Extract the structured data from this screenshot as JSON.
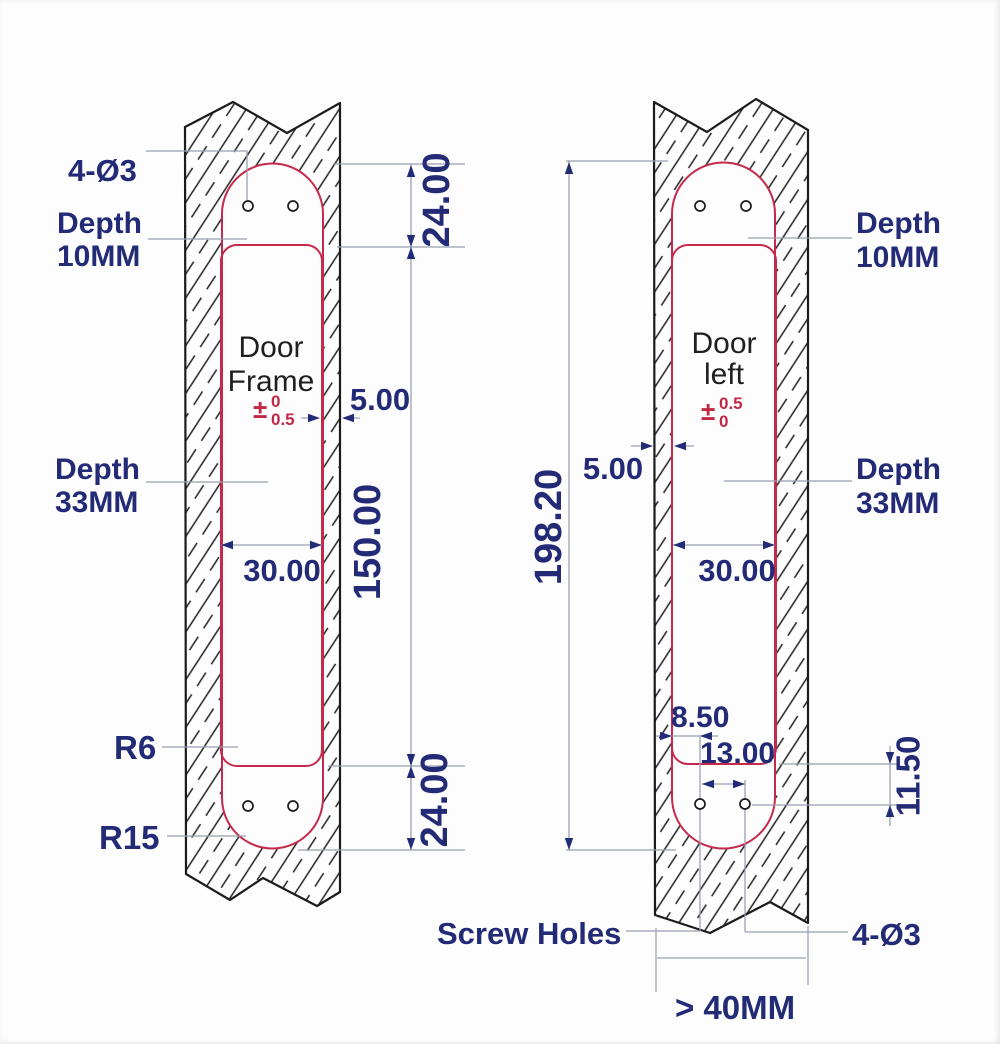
{
  "left_figure": {
    "part_label": {
      "line1": "Door",
      "line2": "Frame"
    },
    "labels": {
      "holes": "4-Ø3",
      "depth_shallow_line1": "Depth",
      "depth_shallow_line2": "10MM",
      "depth_deep_line1": "Depth",
      "depth_deep_line2": "33MM",
      "radius_inner": "R6",
      "radius_outer": "R15"
    },
    "dims": {
      "top_offset": "24.00",
      "pocket_length": "150.00",
      "bottom_offset": "24.00",
      "edge_margin": "5.00",
      "pocket_width": "30.00"
    },
    "tolerance": {
      "sign": "±",
      "upper": "0",
      "lower": "0.5"
    }
  },
  "right_figure": {
    "part_label": {
      "line1": "Door",
      "line2": "left"
    },
    "labels": {
      "depth_shallow_line1": "Depth",
      "depth_shallow_line2": "10MM",
      "depth_deep_line1": "Depth",
      "depth_deep_line2": "33MM",
      "screw_holes": "Screw Holes",
      "holes": "4-Ø3"
    },
    "dims": {
      "mortise_length": "198.20",
      "edge_margin": "5.00",
      "pocket_width": "30.00",
      "hole_edge_offset": "8.50",
      "hole_spacing": "13.00",
      "hole_end_offset": "11.50",
      "min_door_thickness": "> 40MM"
    },
    "tolerance": {
      "sign": "±",
      "upper": "0.5",
      "lower": "0"
    }
  },
  "colors": {
    "dimension_text": "#232b77",
    "mortise_outline": "#c5294b",
    "tolerance_text": "#c22843",
    "part_text": "#1f1f1f",
    "construction_line": "#98a0b0"
  }
}
